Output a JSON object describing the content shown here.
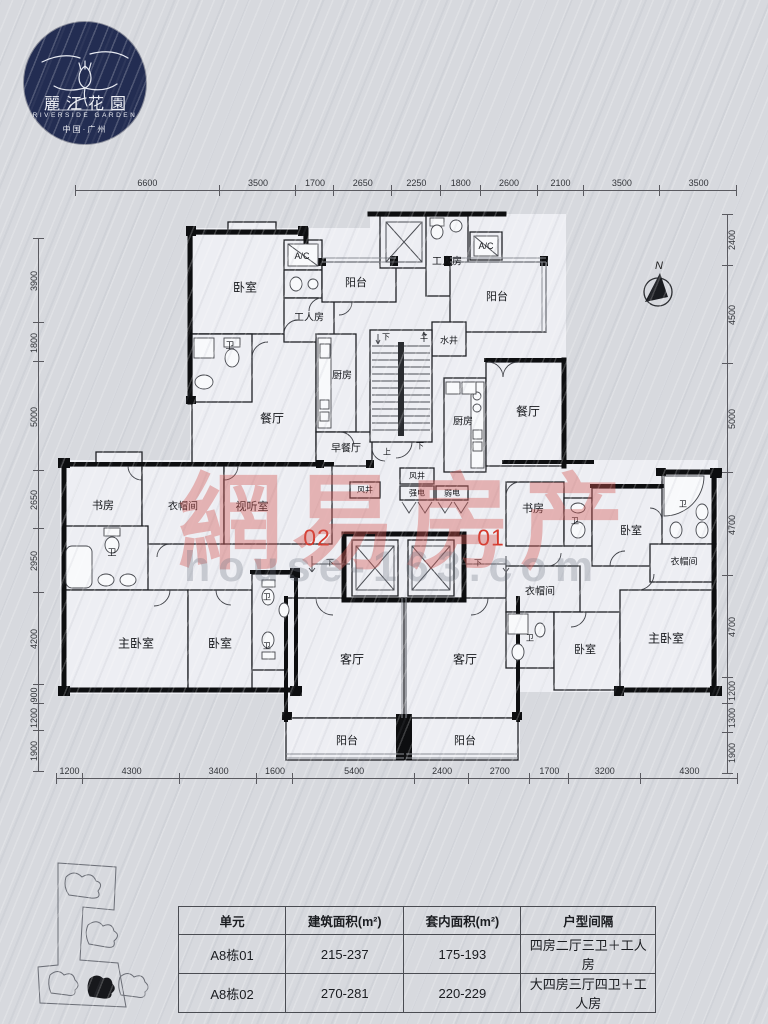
{
  "logo": {
    "name_cn": "麗江花園",
    "name_en": "RIVERSIDE GARDEN",
    "location": "中国·广州"
  },
  "compass": {
    "label": "N"
  },
  "units": {
    "unit01": "01",
    "unit02": "02"
  },
  "watermark": {
    "line1": "網易房产",
    "line2": "house-163.com"
  },
  "accent_colors": {
    "unit_number_red": "#d6392c",
    "watermark_pink": "#d55852",
    "logo_navy": "#232d52"
  },
  "rooms": {
    "bedroom": "卧室",
    "master_bedroom": "主卧室",
    "living_room": "客厅",
    "dining_room": "餐厅",
    "breakfast_room": "早餐厅",
    "kitchen": "厨房",
    "balcony": "阳台",
    "worker_room": "工人房",
    "study": "书房",
    "cloakroom": "衣帽间",
    "av_room": "视听室",
    "bathroom": "卫",
    "water_shaft": "水井",
    "air_shaft": "风井",
    "strong_elec": "强电",
    "weak_elec": "弱电",
    "ac": "A/C",
    "up": "上",
    "down": "下"
  },
  "dims": {
    "top": [
      "6600",
      "3500",
      "1700",
      "2650",
      "2250",
      "1800",
      "2600",
      "2100",
      "3500",
      "3500"
    ],
    "bottom": [
      "1200",
      "4300",
      "3400",
      "1600",
      "5400",
      "2400",
      "2700",
      "1700",
      "3200",
      "4300"
    ],
    "left": [
      "3900",
      "1800",
      "5000",
      "2650",
      "2950",
      "4200",
      "900",
      "1200",
      "1900"
    ],
    "right": [
      "2400",
      "4500",
      "5000",
      "4700",
      "4700",
      "1200",
      "1300",
      "1900"
    ]
  },
  "table": {
    "headers": [
      "单元",
      "建筑面积(m²)",
      "套内面积(m²)",
      "户型间隔"
    ],
    "rows": [
      [
        "A8栋01",
        "215-237",
        "175-193",
        "四房二厅三卫＋工人房"
      ],
      [
        "A8栋02",
        "270-281",
        "220-229",
        "大四房三厅四卫＋工人房"
      ]
    ]
  }
}
